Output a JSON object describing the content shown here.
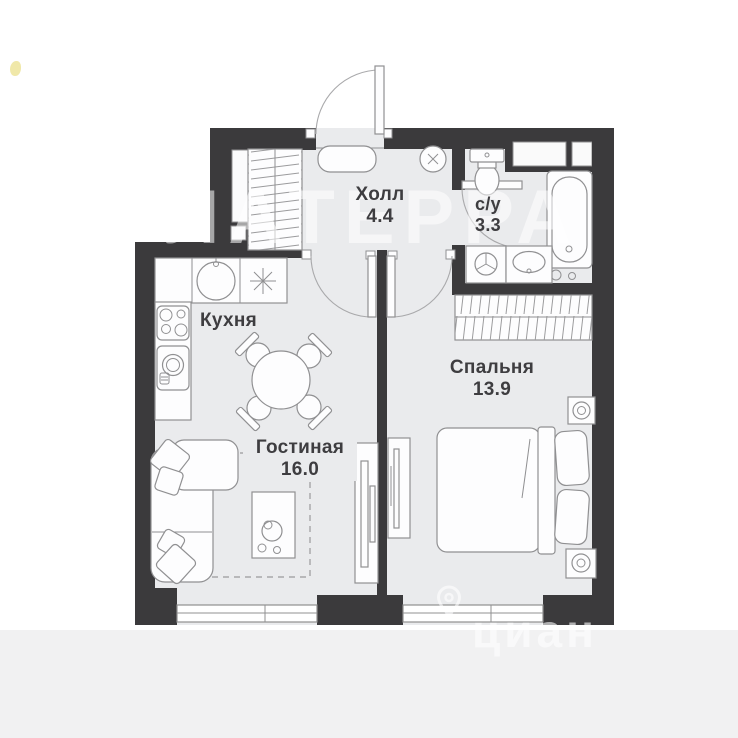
{
  "colors": {
    "wall": "#3b3a3c",
    "floor": "#eaebed",
    "line": "#909092",
    "label": "#3e3d40",
    "bottom_band": "#f1f1f2",
    "corner_mark": "#ece294"
  },
  "rooms": {
    "hall": {
      "name": "Холл",
      "area": "4.4"
    },
    "bathroom": {
      "name": "с/у",
      "area": "3.3"
    },
    "kitchen": {
      "name": "Кухня"
    },
    "bedroom": {
      "name": "Спальня",
      "area": "13.9"
    },
    "living": {
      "name": "Гостиная",
      "area": "16.0"
    }
  },
  "watermarks": {
    "center": "ЛАТЕРРА",
    "bottom": "циан"
  },
  "fixtures": [
    "entrance-door",
    "hall-closet",
    "bench",
    "ceiling-light",
    "toilet",
    "bathtub",
    "washing-machine",
    "washbasin",
    "wardrobe",
    "bed",
    "nightstand",
    "ac-unit",
    "tv-stand",
    "media-console",
    "sofa",
    "coffee-table",
    "dining-table",
    "chairs",
    "kitchen-counter",
    "sink",
    "hob",
    "oven",
    "stove",
    "windows"
  ]
}
